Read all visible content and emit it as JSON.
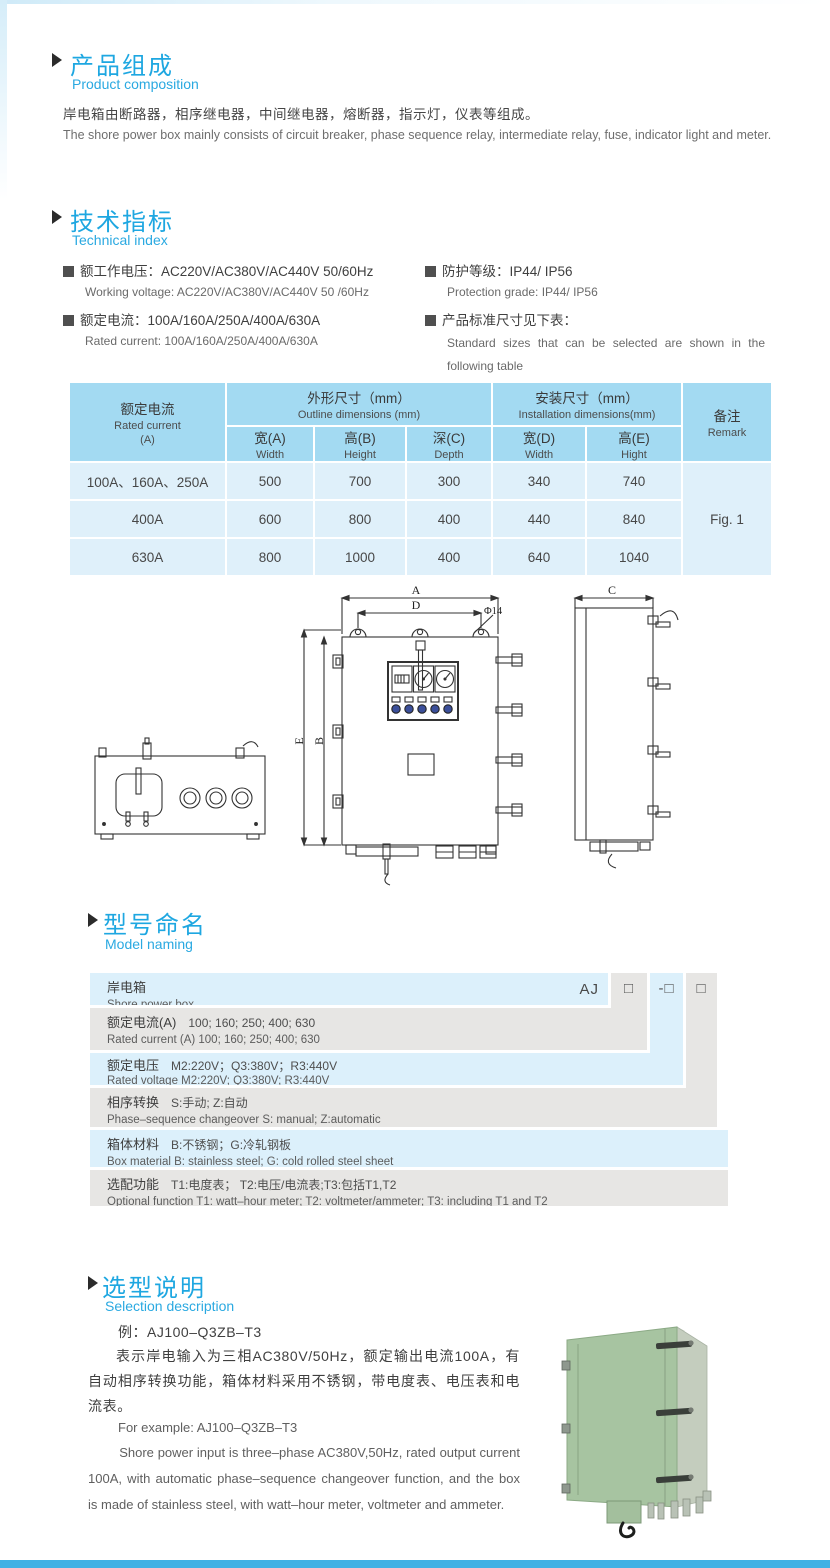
{
  "page": {
    "accent_blue": "#1ea7e1",
    "bottom_bar_color": "#41b1e4"
  },
  "icons": {
    "section_arrow": "right-triangle",
    "spec_bullet": "filled-square",
    "model_box_blank": "□",
    "model_box_dash": "-□"
  },
  "composition": {
    "title_cn": "产品组成",
    "title_en": "Product  composition",
    "para_cn": "岸电箱由断路器，相序继电器，中间继电器，熔断器，指示灯，仪表等组成。",
    "para_en": "The shore power box mainly consists of circuit breaker, phase sequence relay, intermediate relay, fuse, indicator light and meter."
  },
  "technical": {
    "title_cn": "技术指标",
    "title_en": "Technical index",
    "specs": [
      {
        "cn": "额工作电压：AC220V/AC380V/AC440V  50/60Hz",
        "en": "Working voltage: AC220V/AC380V/AC440V 50 /60Hz"
      },
      {
        "cn": "额定电流：100A/160A/250A/400A/630A",
        "en": "Rated current: 100A/160A/250A/400A/630A"
      },
      {
        "cn": "防护等级：IP44/ IP56",
        "en": "Protection grade: IP44/ IP56"
      },
      {
        "cn": "产品标准尺寸见下表：",
        "en": "Standard sizes that can be selected are shown in the following table"
      }
    ]
  },
  "dim_table": {
    "header": {
      "current_cn": "额定电流",
      "current_en": "Rated current",
      "current_unit": "(A)",
      "outline_cn": "外形尺寸（mm）",
      "outline_en": "Outline dimensions (mm)",
      "install_cn": "安装尺寸（mm）",
      "install_en": "Installation dimensions(mm)",
      "remark_cn": "备注",
      "remark_en": "Remark",
      "sub": [
        {
          "cn": "宽(A)",
          "en": "Width"
        },
        {
          "cn": "高(B)",
          "en": "Height"
        },
        {
          "cn": "深(C)",
          "en": "Depth"
        },
        {
          "cn": "宽(D)",
          "en": "Width"
        },
        {
          "cn": "高(E)",
          "en": "Hight"
        }
      ]
    },
    "rows": [
      {
        "current": "100A、160A、250A",
        "w": "500",
        "h": "700",
        "d": "300",
        "iw": "340",
        "ih": "740"
      },
      {
        "current": "400A",
        "w": "600",
        "h": "800",
        "d": "400",
        "iw": "440",
        "ih": "840"
      },
      {
        "current": "630A",
        "w": "800",
        "h": "1000",
        "d": "400",
        "iw": "640",
        "ih": "1040"
      }
    ],
    "remark_value": "Fig. 1"
  },
  "drawing": {
    "dim_a": "A",
    "dim_b": "B",
    "dim_c": "C",
    "dim_d": "D",
    "dim_e": "E",
    "hole_label": "Φ14"
  },
  "model": {
    "title_cn": "型号命名",
    "title_en": "Model naming",
    "prefix": "AJ",
    "box1": "□",
    "box2": "-□",
    "box3": "□",
    "row1": {
      "cn": "岸电箱",
      "en": "Shore power box"
    },
    "row2": {
      "cn": "额定电流(A)",
      "codes": "100; 160; 250; 400; 630",
      "en": "Rated current (A) 100; 160; 250; 400; 630"
    },
    "row3": {
      "cn": "额定电压",
      "codes": "M2:220V；Q3:380V；R3:440V",
      "en": "Rated voltage  M2:220V;  Q3:380V;  R3:440V"
    },
    "row4": {
      "cn": "相序转换",
      "codes": "S:手动; Z:自动",
      "en": "Phase–sequence changeover  S: manual;  Z:automatic"
    },
    "row5": {
      "cn": "箱体材料",
      "codes": "B:不锈钢；G:冷轧钢板",
      "en": "Box material   B: stainless steel; G: cold rolled steel sheet"
    },
    "row6": {
      "cn": "选配功能",
      "codes": "T1:电度表； T2:电压/电流表;T3:包括T1,T2",
      "en": "Optional function  T1: watt–hour meter; T2: voltmeter/ammeter; T3: including T1 and T2"
    }
  },
  "selection": {
    "title_cn": "选型说明",
    "title_en": "Selection description",
    "example_cn": "例：AJ100–Q3ZB–T3",
    "para_cn": "表示岸电输入为三相AC380V/50Hz，额定输出电流100A，有自动相序转换功能，箱体材料采用不锈钢，带电度表、电压表和电流表。",
    "example_en": "For example: AJ100–Q3ZB–T3",
    "para_en": "Shore power input is three–phase AC380V,50Hz, rated output current 100A, with automatic phase–sequence changeover function, and the box is made of stainless steel, with watt–hour meter, voltmeter and ammeter."
  }
}
